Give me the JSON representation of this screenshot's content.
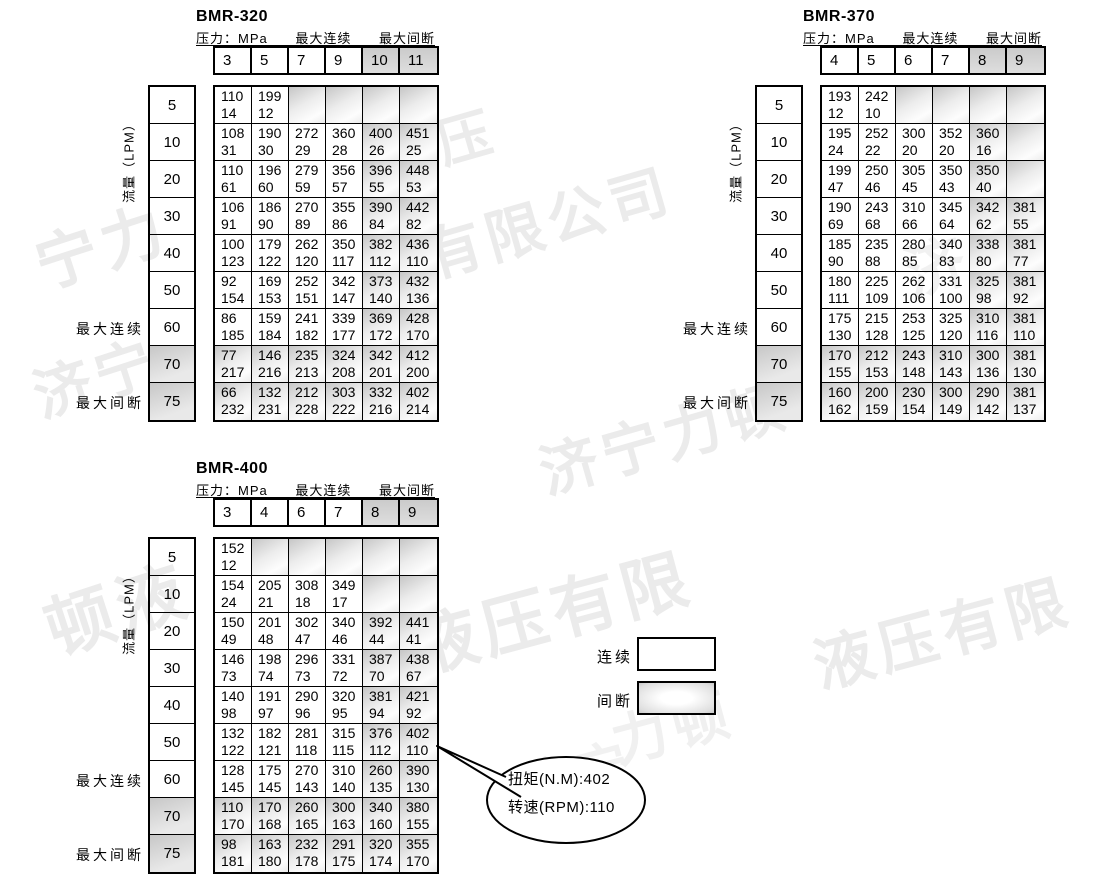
{
  "tables": [
    {
      "title": "BMR-320",
      "pressure_label": "压力：MPa",
      "max_continuous_label": "最大连续",
      "max_intermittent_label": "最大间断",
      "flow_axis_label": "流量（LPM）",
      "row_label_continuous": "最大连续",
      "row_label_intermittent": "最大间断",
      "pressures": [
        "3",
        "5",
        "7",
        "9",
        "10",
        "11"
      ],
      "shaded_col_start": 4,
      "rows": [
        {
          "flow": "5",
          "shaded": false,
          "cells": [
            [
              "110",
              "14"
            ],
            [
              "199",
              "12"
            ],
            null,
            null,
            null,
            null
          ]
        },
        {
          "flow": "10",
          "shaded": false,
          "cells": [
            [
              "108",
              "31"
            ],
            [
              "190",
              "30"
            ],
            [
              "272",
              "29"
            ],
            [
              "360",
              "28"
            ],
            [
              "400",
              "26"
            ],
            [
              "451",
              "25"
            ]
          ]
        },
        {
          "flow": "20",
          "shaded": false,
          "cells": [
            [
              "110",
              "61"
            ],
            [
              "196",
              "60"
            ],
            [
              "279",
              "59"
            ],
            [
              "356",
              "57"
            ],
            [
              "396",
              "55"
            ],
            [
              "448",
              "53"
            ]
          ]
        },
        {
          "flow": "30",
          "shaded": false,
          "cells": [
            [
              "106",
              "91"
            ],
            [
              "186",
              "90"
            ],
            [
              "270",
              "89"
            ],
            [
              "355",
              "86"
            ],
            [
              "390",
              "84"
            ],
            [
              "442",
              "82"
            ]
          ]
        },
        {
          "flow": "40",
          "shaded": false,
          "cells": [
            [
              "100",
              "123"
            ],
            [
              "179",
              "122"
            ],
            [
              "262",
              "120"
            ],
            [
              "350",
              "117"
            ],
            [
              "382",
              "112"
            ],
            [
              "436",
              "110"
            ]
          ]
        },
        {
          "flow": "50",
          "shaded": false,
          "cells": [
            [
              "92",
              "154"
            ],
            [
              "169",
              "153"
            ],
            [
              "252",
              "151"
            ],
            [
              "342",
              "147"
            ],
            [
              "373",
              "140"
            ],
            [
              "432",
              "136"
            ]
          ]
        },
        {
          "flow": "60",
          "shaded": false,
          "cells": [
            [
              "86",
              "185"
            ],
            [
              "159",
              "184"
            ],
            [
              "241",
              "182"
            ],
            [
              "339",
              "177"
            ],
            [
              "369",
              "172"
            ],
            [
              "428",
              "170"
            ]
          ]
        },
        {
          "flow": "70",
          "shaded": true,
          "cells": [
            [
              "77",
              "217"
            ],
            [
              "146",
              "216"
            ],
            [
              "235",
              "213"
            ],
            [
              "324",
              "208"
            ],
            [
              "342",
              "201"
            ],
            [
              "412",
              "200"
            ]
          ]
        },
        {
          "flow": "75",
          "shaded": true,
          "cells": [
            [
              "66",
              "232"
            ],
            [
              "132",
              "231"
            ],
            [
              "212",
              "228"
            ],
            [
              "303",
              "222"
            ],
            [
              "332",
              "216"
            ],
            [
              "402",
              "214"
            ]
          ]
        }
      ]
    },
    {
      "title": "BMR-370",
      "pressure_label": "压力：MPa",
      "max_continuous_label": "最大连续",
      "max_intermittent_label": "最大间断",
      "flow_axis_label": "流量（LPM）",
      "row_label_continuous": "最大连续",
      "row_label_intermittent": "最大间断",
      "pressures": [
        "4",
        "5",
        "6",
        "7",
        "8",
        "9"
      ],
      "shaded_col_start": 4,
      "rows": [
        {
          "flow": "5",
          "shaded": false,
          "cells": [
            [
              "193",
              "12"
            ],
            [
              "242",
              "10"
            ],
            null,
            null,
            null,
            null
          ]
        },
        {
          "flow": "10",
          "shaded": false,
          "cells": [
            [
              "195",
              "24"
            ],
            [
              "252",
              "22"
            ],
            [
              "300",
              "20"
            ],
            [
              "352",
              "20"
            ],
            [
              "360",
              "16"
            ],
            null
          ]
        },
        {
          "flow": "20",
          "shaded": false,
          "cells": [
            [
              "199",
              "47"
            ],
            [
              "250",
              "46"
            ],
            [
              "305",
              "45"
            ],
            [
              "350",
              "43"
            ],
            [
              "350",
              "40"
            ],
            null
          ]
        },
        {
          "flow": "30",
          "shaded": false,
          "cells": [
            [
              "190",
              "69"
            ],
            [
              "243",
              "68"
            ],
            [
              "310",
              "66"
            ],
            [
              "345",
              "64"
            ],
            [
              "342",
              "62"
            ],
            [
              "381",
              "55"
            ]
          ]
        },
        {
          "flow": "40",
          "shaded": false,
          "cells": [
            [
              "185",
              "90"
            ],
            [
              "235",
              "88"
            ],
            [
              "280",
              "85"
            ],
            [
              "340",
              "83"
            ],
            [
              "338",
              "80"
            ],
            [
              "381",
              "77"
            ]
          ]
        },
        {
          "flow": "50",
          "shaded": false,
          "cells": [
            [
              "180",
              "111"
            ],
            [
              "225",
              "109"
            ],
            [
              "262",
              "106"
            ],
            [
              "331",
              "100"
            ],
            [
              "325",
              "98"
            ],
            [
              "381",
              "92"
            ]
          ]
        },
        {
          "flow": "60",
          "shaded": false,
          "cells": [
            [
              "175",
              "130"
            ],
            [
              "215",
              "128"
            ],
            [
              "253",
              "125"
            ],
            [
              "325",
              "120"
            ],
            [
              "310",
              "116"
            ],
            [
              "381",
              "110"
            ]
          ]
        },
        {
          "flow": "70",
          "shaded": true,
          "cells": [
            [
              "170",
              "155"
            ],
            [
              "212",
              "153"
            ],
            [
              "243",
              "148"
            ],
            [
              "310",
              "143"
            ],
            [
              "300",
              "136"
            ],
            [
              "381",
              "130"
            ]
          ]
        },
        {
          "flow": "75",
          "shaded": true,
          "cells": [
            [
              "160",
              "162"
            ],
            [
              "200",
              "159"
            ],
            [
              "230",
              "154"
            ],
            [
              "300",
              "149"
            ],
            [
              "290",
              "142"
            ],
            [
              "381",
              "137"
            ]
          ]
        }
      ]
    },
    {
      "title": "BMR-400",
      "pressure_label": "压力：MPa",
      "max_continuous_label": "最大连续",
      "max_intermittent_label": "最大间断",
      "flow_axis_label": "流量（LPM）",
      "row_label_continuous": "最大连续",
      "row_label_intermittent": "最大间断",
      "pressures": [
        "3",
        "4",
        "6",
        "7",
        "8",
        "9"
      ],
      "shaded_col_start": 4,
      "rows": [
        {
          "flow": "5",
          "shaded": false,
          "cells": [
            [
              "152",
              "12"
            ],
            null,
            null,
            null,
            null,
            null
          ]
        },
        {
          "flow": "10",
          "shaded": false,
          "cells": [
            [
              "154",
              "24"
            ],
            [
              "205",
              "21"
            ],
            [
              "308",
              "18"
            ],
            [
              "349",
              "17"
            ],
            null,
            null
          ]
        },
        {
          "flow": "20",
          "shaded": false,
          "cells": [
            [
              "150",
              "49"
            ],
            [
              "201",
              "48"
            ],
            [
              "302",
              "47"
            ],
            [
              "340",
              "46"
            ],
            [
              "392",
              "44"
            ],
            [
              "441",
              "41"
            ]
          ]
        },
        {
          "flow": "30",
          "shaded": false,
          "cells": [
            [
              "146",
              "73"
            ],
            [
              "198",
              "74"
            ],
            [
              "296",
              "73"
            ],
            [
              "331",
              "72"
            ],
            [
              "387",
              "70"
            ],
            [
              "438",
              "67"
            ]
          ]
        },
        {
          "flow": "40",
          "shaded": false,
          "cells": [
            [
              "140",
              "98"
            ],
            [
              "191",
              "97"
            ],
            [
              "290",
              "96"
            ],
            [
              "320",
              "95"
            ],
            [
              "381",
              "94"
            ],
            [
              "421",
              "92"
            ]
          ]
        },
        {
          "flow": "50",
          "shaded": false,
          "cells": [
            [
              "132",
              "122"
            ],
            [
              "182",
              "121"
            ],
            [
              "281",
              "118"
            ],
            [
              "315",
              "115"
            ],
            [
              "376",
              "112"
            ],
            [
              "402",
              "110"
            ]
          ]
        },
        {
          "flow": "60",
          "shaded": false,
          "cells": [
            [
              "128",
              "145"
            ],
            [
              "175",
              "145"
            ],
            [
              "270",
              "143"
            ],
            [
              "310",
              "140"
            ],
            [
              "260",
              "135"
            ],
            [
              "390",
              "130"
            ]
          ]
        },
        {
          "flow": "70",
          "shaded": true,
          "cells": [
            [
              "110",
              "170"
            ],
            [
              "170",
              "168"
            ],
            [
              "260",
              "165"
            ],
            [
              "300",
              "163"
            ],
            [
              "340",
              "160"
            ],
            [
              "380",
              "155"
            ]
          ]
        },
        {
          "flow": "75",
          "shaded": true,
          "cells": [
            [
              "98",
              "181"
            ],
            [
              "163",
              "180"
            ],
            [
              "232",
              "178"
            ],
            [
              "291",
              "175"
            ],
            [
              "320",
              "174"
            ],
            [
              "355",
              "170"
            ]
          ]
        }
      ]
    }
  ],
  "legend": {
    "continuous_label": "连续",
    "intermittent_label": "间断"
  },
  "callout": {
    "line1": "扭矩(N.M):402",
    "line2": "转速(RPM):110"
  },
  "watermarks": [
    {
      "text": "宁力"
    },
    {
      "text": "济宁"
    },
    {
      "text": "压"
    },
    {
      "text": "有限公司"
    },
    {
      "text": "济宁力顿"
    },
    {
      "text": "液压有限"
    },
    {
      "text": "液压有限"
    },
    {
      "text": "顿液"
    },
    {
      "text": "济"
    },
    {
      "text": "力顿"
    },
    {
      "text": "济宁"
    }
  ]
}
